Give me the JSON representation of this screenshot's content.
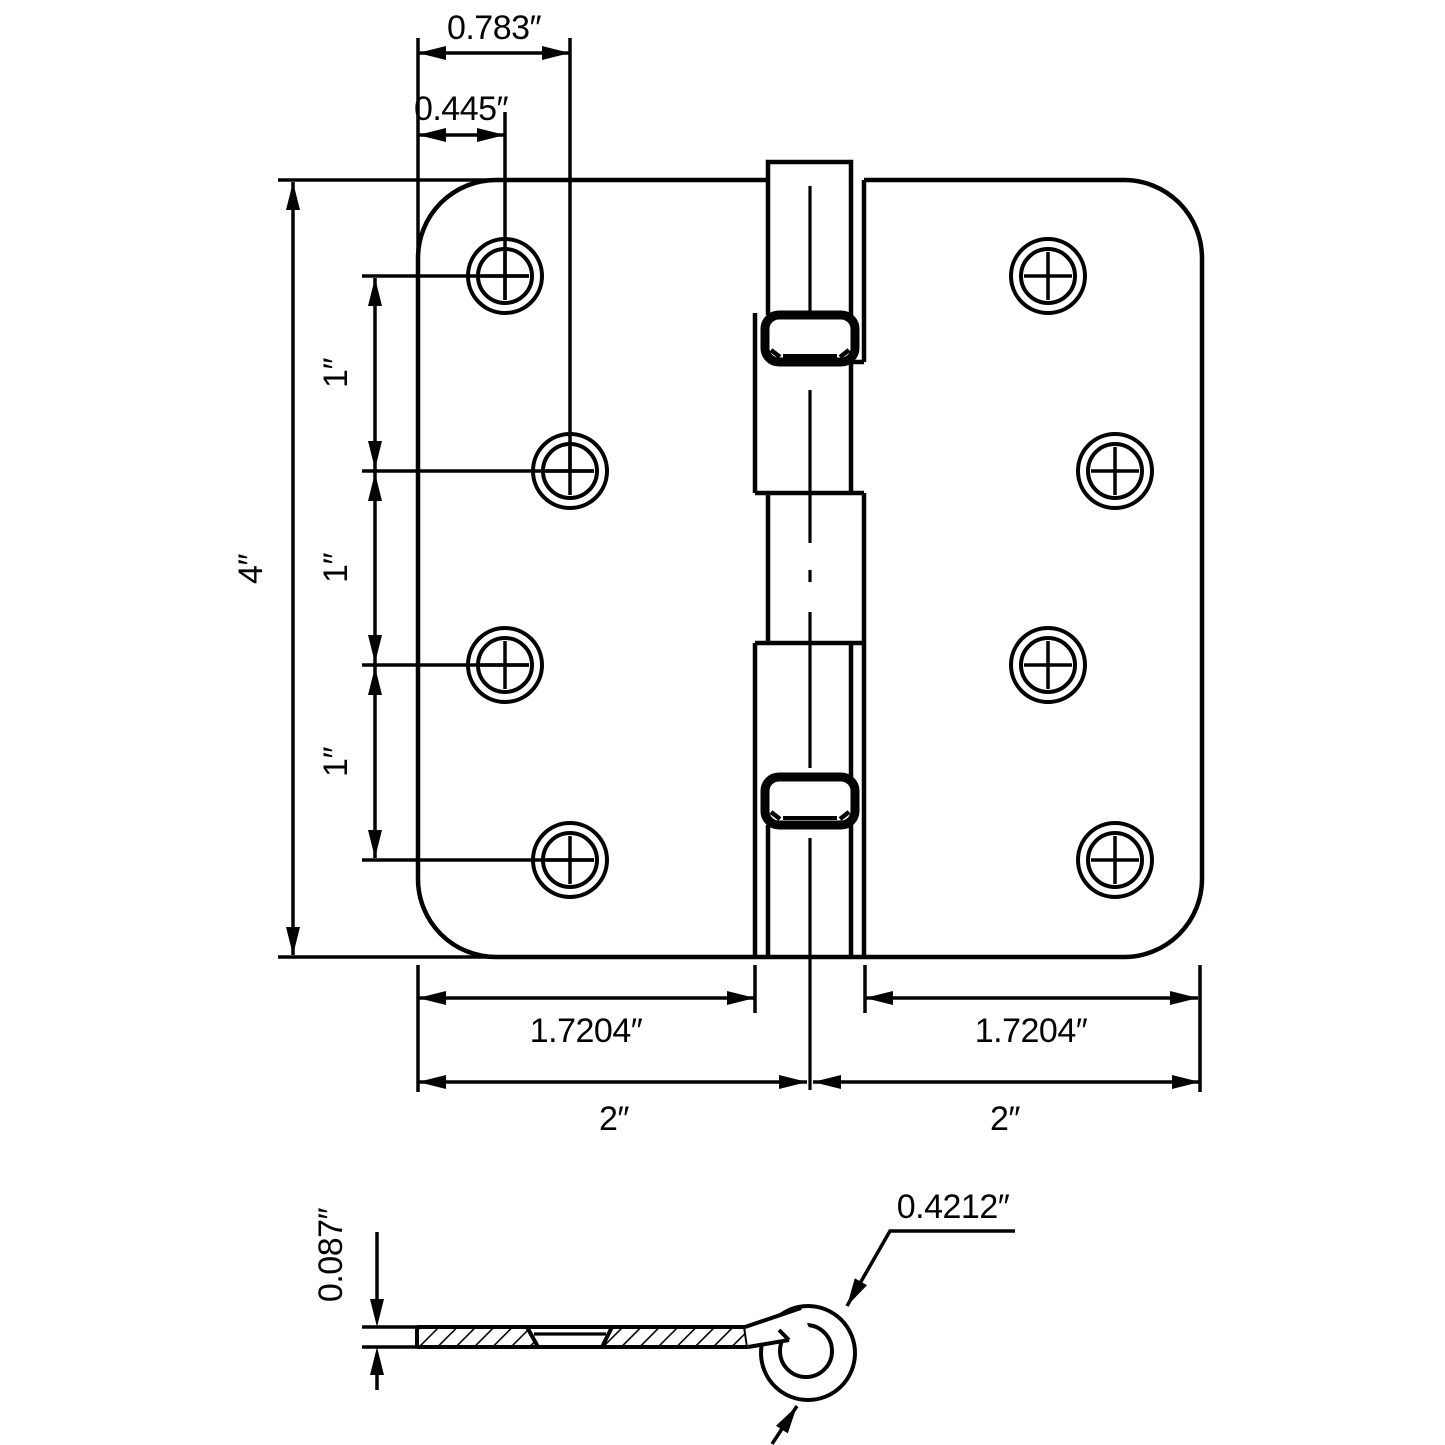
{
  "page": {
    "background": "#ffffff",
    "line_color": "#030303",
    "description": "Technical dimension drawing of a 4 inch door hinge, front view and side cross-section"
  },
  "front_view": {
    "dims": {
      "top_hole_offset": "0.783″",
      "corner_hole_offset": "0.445″",
      "height": "4″",
      "hole_spacing_top": "1″",
      "hole_spacing_middle": "1″",
      "hole_spacing_bottom": "1″",
      "left_leaf_width": "1.7204″",
      "right_leaf_width": "1.7204″",
      "left_half_width": "2″",
      "right_half_width": "2″"
    }
  },
  "side_view": {
    "dims": {
      "leaf_thickness": "0.087″",
      "knuckle_diameter": "0.4212″"
    }
  }
}
